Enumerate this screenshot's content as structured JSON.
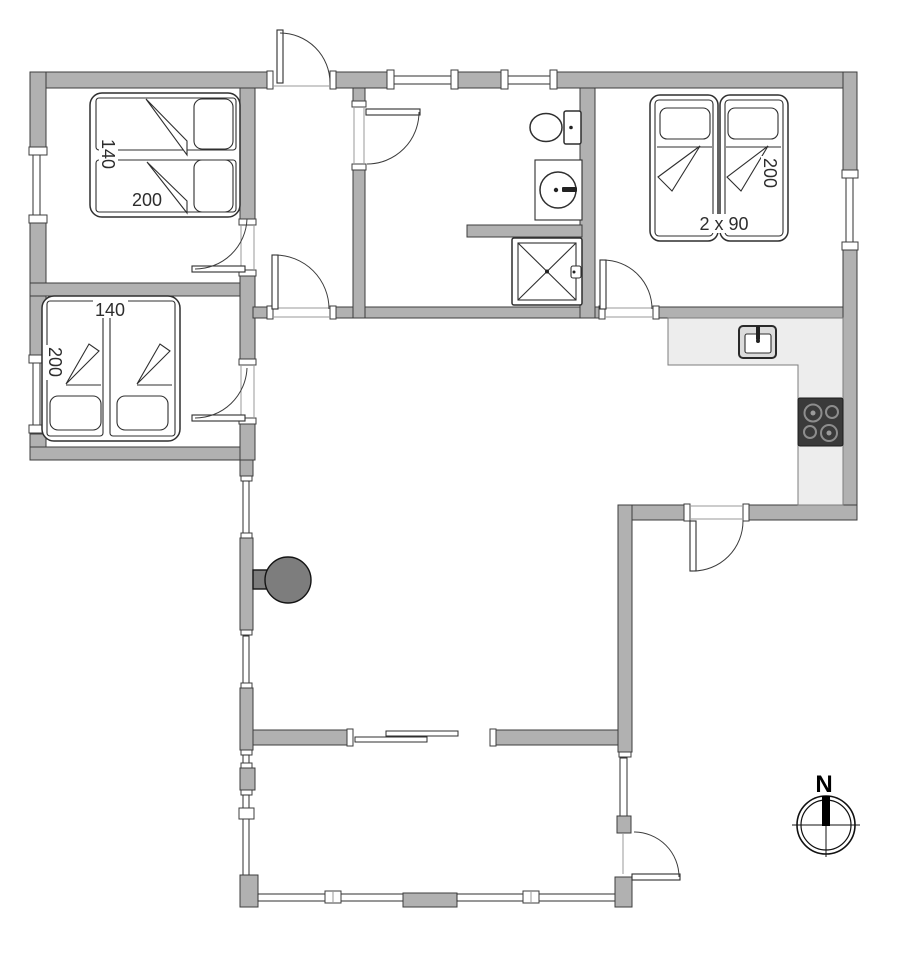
{
  "floorplan": {
    "bedroom_top_left": {
      "bed_width_label": "140",
      "bed_length_label": "200"
    },
    "bedroom_bottom_left": {
      "bed_width_label": "140",
      "bed_length_label": "200"
    },
    "bedroom_right": {
      "bed_size_label": "2 x 90",
      "bed_length_label": "200"
    },
    "compass": {
      "north_label": "N"
    },
    "colors": {
      "wall": "#b1b1b1",
      "wall_outline": "#3d3d3d",
      "counter": "#ededed",
      "stove": "#3a3a3a",
      "wood_stove": "#7d7d7d"
    }
  }
}
